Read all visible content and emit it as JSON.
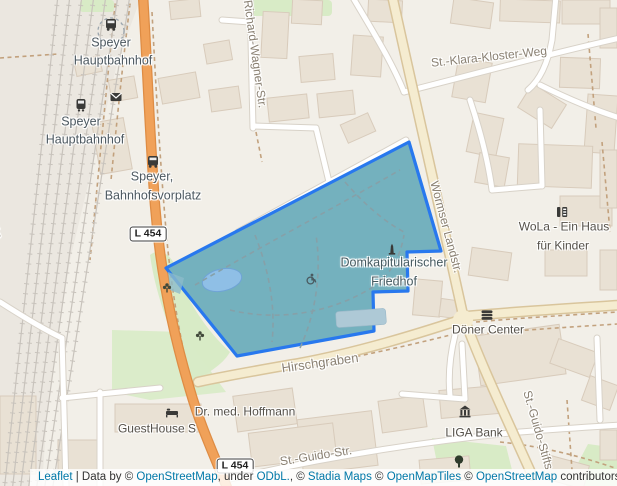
{
  "map": {
    "labels": {
      "station_top": {
        "line1": "Speyer",
        "line2": "Hauptbahnhof"
      },
      "station_main": {
        "line1": "Speyer",
        "line2": "Hauptbahnhof"
      },
      "bus_stop": {
        "line1": "Speyer,",
        "line2": "Bahnhofsvorplatz"
      },
      "richard_wagner": "Richard-Wagner-Str.",
      "st_klara": "St.-Klara-Kloster-Weg",
      "wormser": "Wormser Landstr.",
      "wola": {
        "line1": "WoLa - Ein Haus",
        "line2": "für Kinder"
      },
      "cemetery": {
        "line1": "Domkapitularischer",
        "line2": "Friedhof"
      },
      "doener": "Döner Center",
      "hirschgraben": "Hirschgraben",
      "hoffmann": "Dr. med. Hoffmann",
      "guesthouse": "GuestHouse S",
      "liga": "LIGA Bank",
      "st_guido_str": "St.-Guido-Str.",
      "st_guido_stifts": "St.-Guido-Stifts",
      "burgstrasse": "Burgstraße",
      "route_badge": "L 454"
    },
    "icons": [
      "bus-icon",
      "train-icon",
      "mail-icon",
      "monument-icon",
      "wheelchair-icon",
      "flower-icon",
      "fast-food-icon",
      "bank-icon",
      "bed-icon",
      "tree-icon"
    ],
    "colors": {
      "highlight_stroke": "#2878EE",
      "highlight_fill": "#74B1BE",
      "water": "#8FBFE6",
      "road_orange": "#F0A159",
      "road_tan": "#F5ECD0",
      "green": "#D8EBC6",
      "link": "#0078A8"
    },
    "attribution": {
      "leaflet": "Leaflet",
      "divider": " | Data by © ",
      "osm1": "OpenStreetMap",
      "under": ", under ",
      "odbl": "ODbL.",
      "sep1": ", © ",
      "stadia": "Stadia Maps",
      "sep2": " © ",
      "openmaptiles": "OpenMapTiles",
      "sep3": " © ",
      "osm2": "OpenStreetMap",
      "contributors": " contributors"
    }
  }
}
